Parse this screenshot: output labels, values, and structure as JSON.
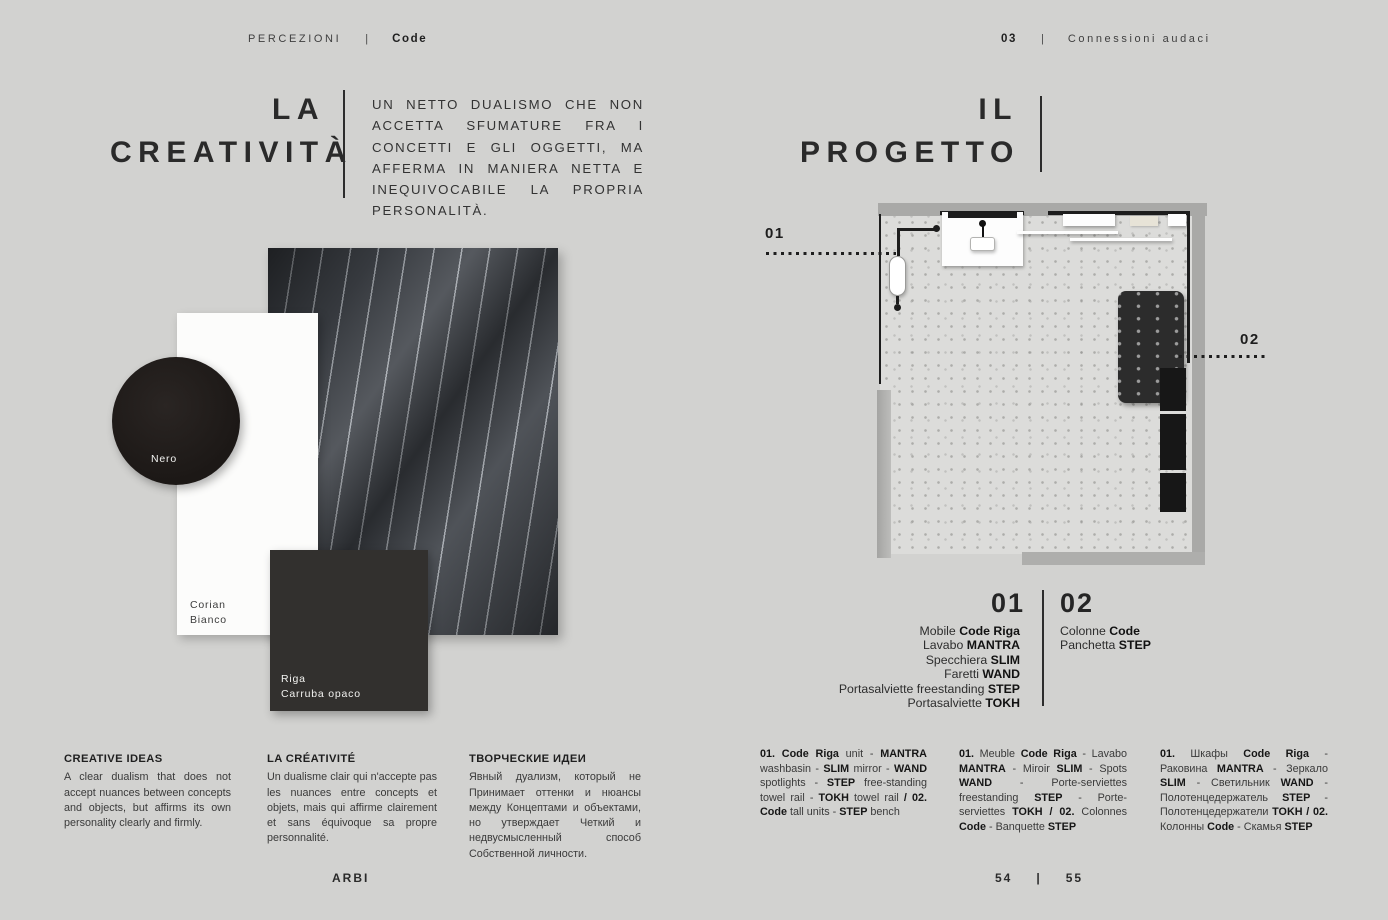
{
  "colors": {
    "page_bg": "#d2d2d0",
    "ink": "#2a2a2a",
    "nero_swatch": "#1d1916",
    "corian_swatch": "#fcfcfb",
    "riga_swatch": "#342a25",
    "fabric_swatch": "#42464c",
    "plan_wall": "#a9a9a7"
  },
  "header": {
    "left": {
      "section": "PERCEZIONI",
      "divider": "|",
      "collection": "Code"
    },
    "right": {
      "number": "03",
      "divider": "|",
      "chapter": "Connessioni audaci"
    }
  },
  "footer": {
    "brand": "ARBI",
    "page_left": "54",
    "divider": "|",
    "page_right": "55"
  },
  "left_page": {
    "title_line1": "LA",
    "title_line2": "CREATIVITÀ",
    "intro": "UN NETTO DUALISMO CHE NON ACCETTA SFUMATURE FRA I CONCETTI E GLI OGGETTI, MA AFFERMA IN MANIERA NETTA E INEQUIVOCABILE LA PROPRIA PERSONALITÀ.",
    "swatches": {
      "nero_label": "Nero",
      "corian_label_line1": "Corian",
      "corian_label_line2": "Bianco",
      "riga_label_line1": "Riga",
      "riga_label_line2": "Carruba opaco"
    },
    "columns": [
      {
        "title": "CREATIVE IDEAS",
        "body": "A clear dualism that does not accept nuances between concepts and objects, but affirms its own personality clearly and firmly."
      },
      {
        "title": "LA CRÉATIVITÉ",
        "body": "Un dualisme clair qui n'accepte pas les nuances entre concepts et objets, mais qui affirme clairement et sans équivoque sa propre personnalité."
      },
      {
        "title": "ТВОРЧЕСКИЕ ИДЕИ",
        "body": "Явный дуализм, который не Принимает оттенки и нюансы между Концептами и объектами, но утверждает Четкий и недвусмысленный способ Собственной личности."
      }
    ]
  },
  "right_page": {
    "title_line1": "IL",
    "title_line2": "PROGETTO",
    "plan_callouts": {
      "c01": "01",
      "c02": "02"
    },
    "legend": {
      "num01": "01",
      "num02": "02",
      "list01": [
        {
          "normal": "Mobile ",
          "bold": "Code Riga"
        },
        {
          "normal": "Lavabo ",
          "bold": "MANTRA"
        },
        {
          "normal": "Specchiera ",
          "bold": "SLIM"
        },
        {
          "normal": "Faretti ",
          "bold": "WAND"
        },
        {
          "normal": "Portasalviette freestanding ",
          "bold": "STEP"
        },
        {
          "normal": "Portasalviette ",
          "bold": "TOKH"
        }
      ],
      "list02": [
        {
          "normal": "Colonne ",
          "bold": "Code"
        },
        {
          "normal": "Panchetta ",
          "bold": "STEP"
        }
      ]
    },
    "descriptions": {
      "en": [
        {
          "t": "01. Code Riga",
          "b": true
        },
        {
          "t": " unit - "
        },
        {
          "t": "MANTRA",
          "b": true
        },
        {
          "t": " washbasin - "
        },
        {
          "t": "SLIM",
          "b": true
        },
        {
          "t": " mirror - "
        },
        {
          "t": "WAND",
          "b": true
        },
        {
          "t": " spotlights - "
        },
        {
          "t": "STEP",
          "b": true
        },
        {
          "t": " free-standing towel rail - "
        },
        {
          "t": "TOKH",
          "b": true
        },
        {
          "t": " towel rail "
        },
        {
          "t": "/ 02. Code",
          "b": true
        },
        {
          "t": " tall units - "
        },
        {
          "t": "STEP",
          "b": true
        },
        {
          "t": " bench"
        }
      ],
      "fr": [
        {
          "t": "01.",
          "b": true
        },
        {
          "t": " Meuble "
        },
        {
          "t": "Code Riga",
          "b": true
        },
        {
          "t": " - Lavabo "
        },
        {
          "t": "MANTRA",
          "b": true
        },
        {
          "t": " - Miroir "
        },
        {
          "t": "SLIM",
          "b": true
        },
        {
          "t": " - Spots "
        },
        {
          "t": "WAND",
          "b": true
        },
        {
          "t": " - Porte-serviettes freestanding "
        },
        {
          "t": "STEP",
          "b": true
        },
        {
          "t": " - Porte-serviettes "
        },
        {
          "t": "TOKH / 02.",
          "b": true
        },
        {
          "t": " Colonnes "
        },
        {
          "t": "Code",
          "b": true
        },
        {
          "t": " - Banquette "
        },
        {
          "t": "STEP",
          "b": true
        }
      ],
      "ru": [
        {
          "t": "01.",
          "b": true
        },
        {
          "t": " Шкафы "
        },
        {
          "t": "Code Riga",
          "b": true
        },
        {
          "t": " - Раковина "
        },
        {
          "t": "MANTRA",
          "b": true
        },
        {
          "t": " - Зеркало "
        },
        {
          "t": "SLIM",
          "b": true
        },
        {
          "t": " - Светильник "
        },
        {
          "t": "WAND",
          "b": true
        },
        {
          "t": " - Полотенцедержатель "
        },
        {
          "t": "STEP",
          "b": true
        },
        {
          "t": " - Полотенцедержатели "
        },
        {
          "t": "TOKH / 02.",
          "b": true
        },
        {
          "t": " Колонны "
        },
        {
          "t": "Code",
          "b": true
        },
        {
          "t": " - Скамья "
        },
        {
          "t": "STEP",
          "b": true
        }
      ]
    }
  }
}
